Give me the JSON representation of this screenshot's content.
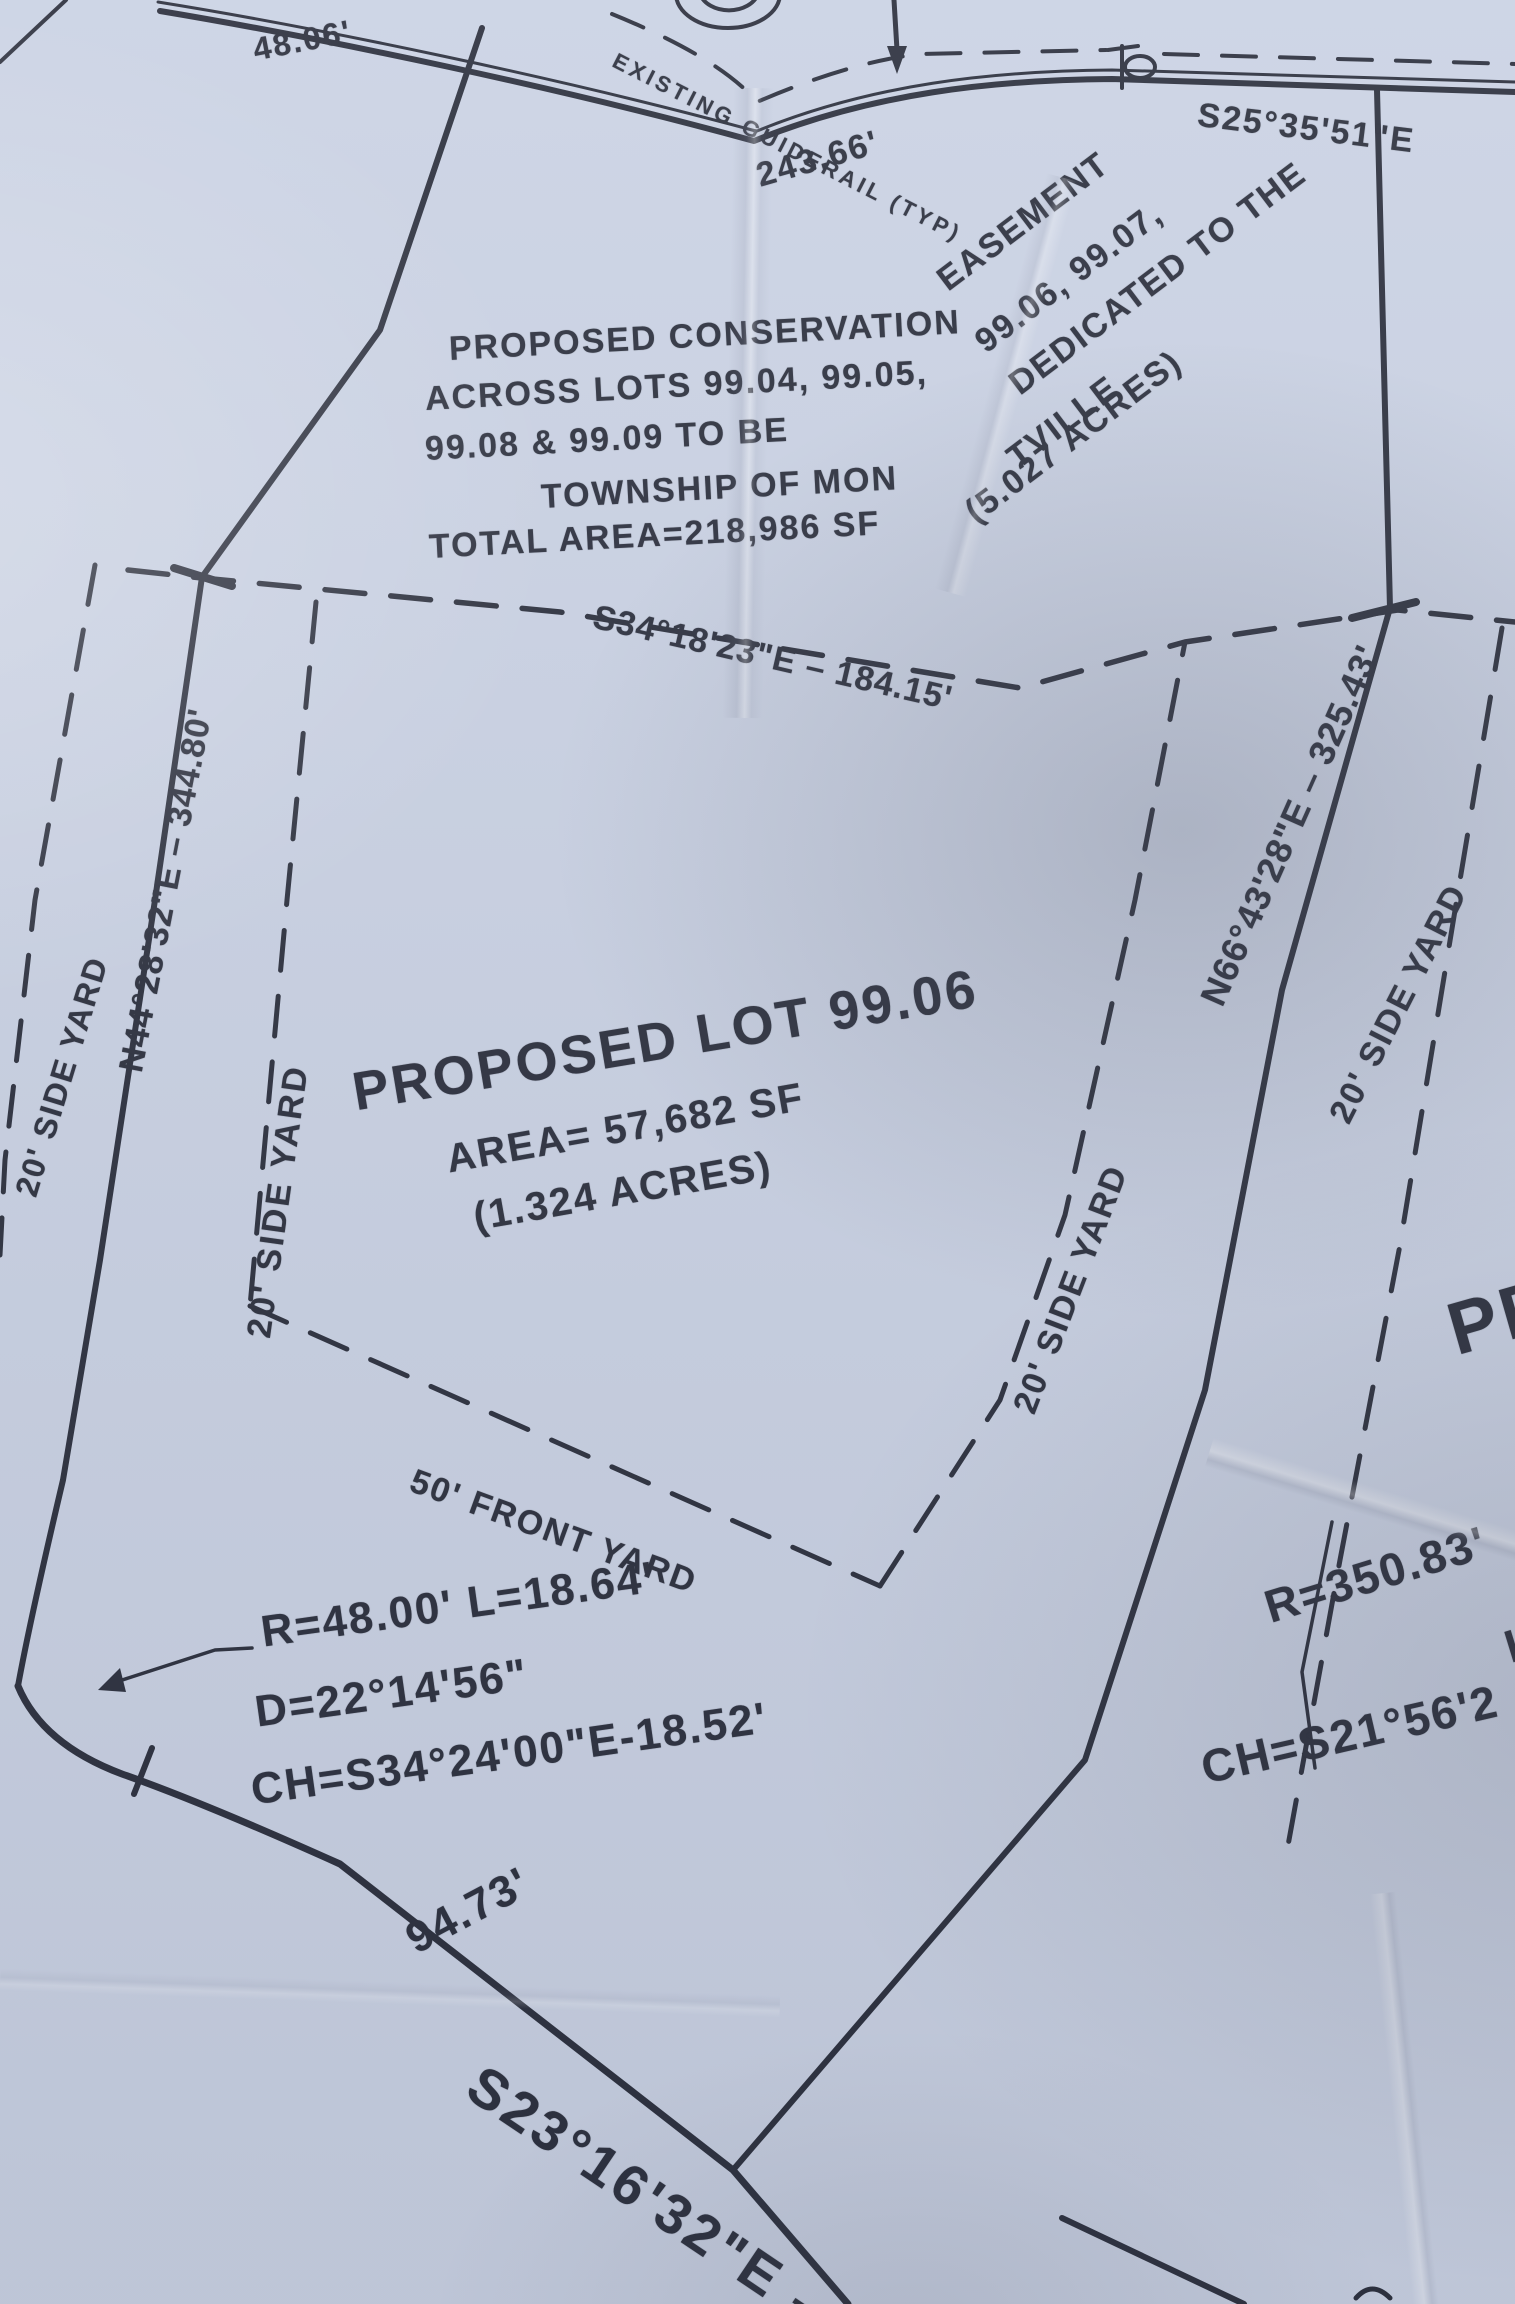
{
  "colors": {
    "paper": "#c9d1e3",
    "ink": "#272b39"
  },
  "top": {
    "dim_48": "48.06'",
    "guiderail": "EXISTING GUIDERAIL (TYP)",
    "dim_243": "243.66'",
    "bearing_s25": "S25°35'51\"E"
  },
  "easement_note": {
    "l1a": "PROPOSED CONSERVATION",
    "l1b": "EASEMENT",
    "l2a": "ACROSS LOTS 99.04, 99.05,",
    "l2b": "99.06, 99.07,",
    "l3a": "99.08 & 99.09 TO BE",
    "l3b": "DEDICATED TO THE",
    "l4a": "TOWNSHIP OF MON",
    "l4b": "TVILLE",
    "l5a": "TOTAL AREA=218,986 SF",
    "l5b": "(5.027 ACRES)"
  },
  "boundaries": {
    "north_bearing": "S34°18'23\"E – 184.15'",
    "west_bearing": "N44°28'32\"E – 344.80'",
    "east_bearing": "N66°43'28\"E – 325.43'"
  },
  "yards": {
    "left_outer": "20' SIDE YARD",
    "left": "20' SIDE YARD",
    "right": "20' SIDE YARD",
    "right_outer": "20' SIDE YARD",
    "front": "50' FRONT YARD"
  },
  "lot": {
    "title": "PROPOSED LOT 99.06",
    "area": "AREA= 57,682 SF",
    "acres": "(1.324 ACRES)"
  },
  "curve_a": {
    "l1": "R=48.00' L=18.64'",
    "l2": "D=22°14'56\"",
    "l3": "CH=S34°24'00\"E-18.52'"
  },
  "curve_b": {
    "r": "R=350.83'",
    "partial_l": "L",
    "ch": "CH=S21°56'2"
  },
  "road_bottom": {
    "dim_94": "94.73'",
    "bearing_s23": "S23°16'32\"E – 1"
  },
  "adjacent": {
    "partial": "PR"
  }
}
